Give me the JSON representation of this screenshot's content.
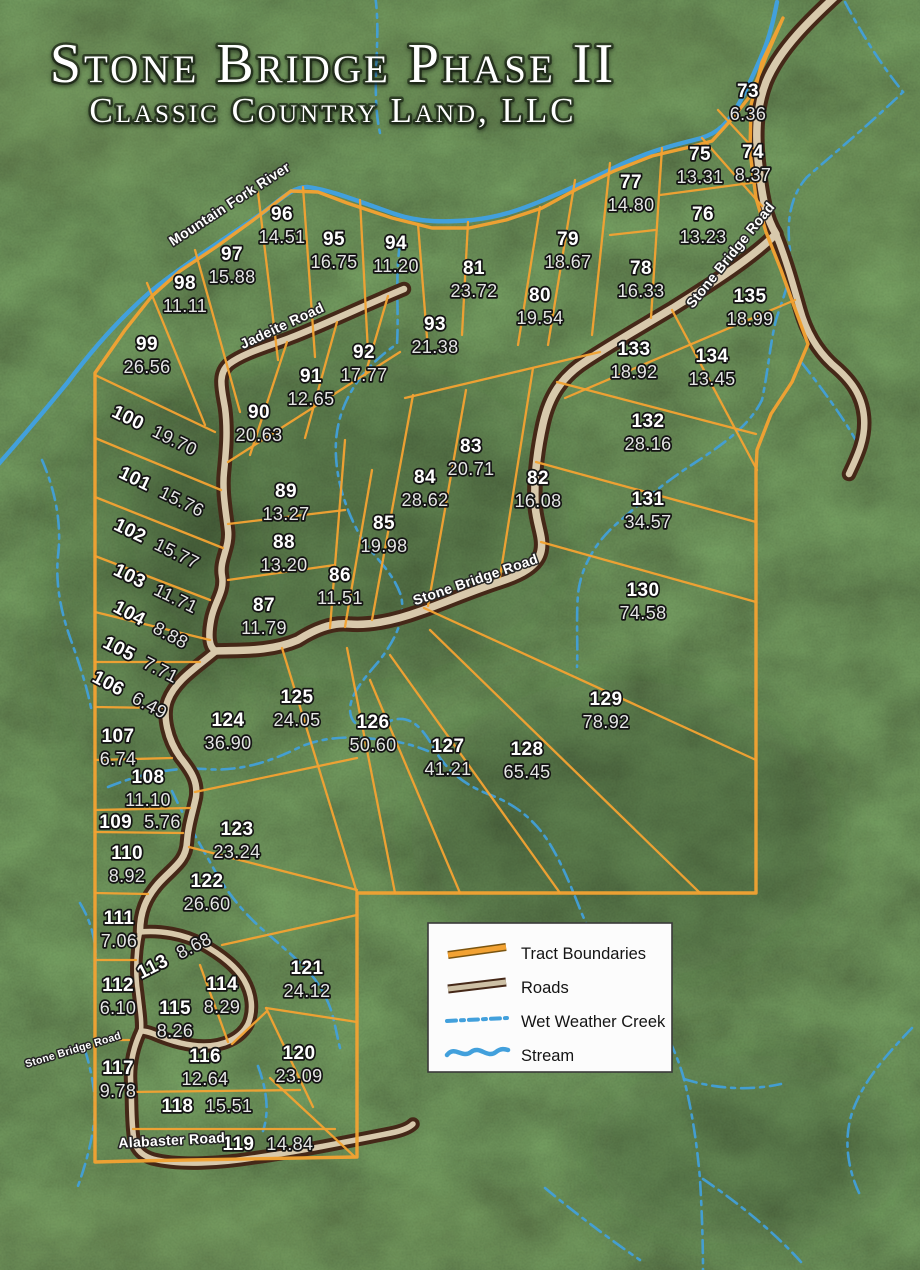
{
  "title": {
    "main": "Stone Bridge Phase II",
    "sub": "Classic Country Land, LLC"
  },
  "colors": {
    "boundary": "#F2A233",
    "road": "#D8C9AC",
    "road_casing": "#452818",
    "water": "#42A0DC",
    "label": "#FFFFFF"
  },
  "legend": {
    "items": [
      {
        "label": "Tract Boundaries",
        "swatch": "boundary"
      },
      {
        "label": "Roads",
        "swatch": "road"
      },
      {
        "label": "Wet Weather Creek",
        "swatch": "creek"
      },
      {
        "label": "Stream",
        "swatch": "stream"
      }
    ]
  },
  "road_labels": [
    {
      "text": "Mountain Fork River",
      "x": 232,
      "y": 208,
      "rot": -33,
      "size": 14
    },
    {
      "text": "Jadeite Road",
      "x": 284,
      "y": 330,
      "rot": -25,
      "size": 14
    },
    {
      "text": "Stone Bridge Road",
      "x": 734,
      "y": 258,
      "rot": -51,
      "size": 14
    },
    {
      "text": "Stone Bridge Road",
      "x": 477,
      "y": 584,
      "rot": -19,
      "size": 14
    },
    {
      "text": "Stone Bridge Road",
      "x": 74,
      "y": 1053,
      "rot": -17,
      "size": 10.5
    },
    {
      "text": "Alabaster Road",
      "x": 172,
      "y": 1145,
      "rot": -3,
      "size": 14
    }
  ],
  "tracts": [
    {
      "n": "73",
      "a": "6.36",
      "x": 748,
      "y": 97
    },
    {
      "n": "74",
      "a": "8.37",
      "x": 753,
      "y": 158
    },
    {
      "n": "75",
      "a": "13.31",
      "x": 700,
      "y": 160
    },
    {
      "n": "76",
      "a": "13.23",
      "x": 703,
      "y": 220
    },
    {
      "n": "77",
      "a": "14.80",
      "x": 631,
      "y": 188
    },
    {
      "n": "78",
      "a": "16.33",
      "x": 641,
      "y": 274
    },
    {
      "n": "79",
      "a": "18.67",
      "x": 568,
      "y": 245
    },
    {
      "n": "80",
      "a": "19.54",
      "x": 540,
      "y": 301
    },
    {
      "n": "81",
      "a": "23.72",
      "x": 474,
      "y": 274
    },
    {
      "n": "82",
      "a": "16.08",
      "x": 538,
      "y": 484
    },
    {
      "n": "83",
      "a": "20.71",
      "x": 471,
      "y": 452
    },
    {
      "n": "84",
      "a": "28.62",
      "x": 425,
      "y": 483
    },
    {
      "n": "85",
      "a": "19.98",
      "x": 384,
      "y": 529
    },
    {
      "n": "86",
      "a": "11.51",
      "x": 340,
      "y": 581
    },
    {
      "n": "87",
      "a": "11.79",
      "x": 264,
      "y": 611
    },
    {
      "n": "88",
      "a": "13.20",
      "x": 284,
      "y": 548
    },
    {
      "n": "89",
      "a": "13.27",
      "x": 286,
      "y": 497
    },
    {
      "n": "90",
      "a": "20.63",
      "x": 259,
      "y": 418
    },
    {
      "n": "91",
      "a": "12.65",
      "x": 311,
      "y": 382
    },
    {
      "n": "92",
      "a": "17.77",
      "x": 364,
      "y": 358
    },
    {
      "n": "93",
      "a": "21.38",
      "x": 435,
      "y": 330
    },
    {
      "n": "94",
      "a": "11.20",
      "x": 396,
      "y": 249
    },
    {
      "n": "95",
      "a": "16.75",
      "x": 334,
      "y": 245
    },
    {
      "n": "96",
      "a": "14.51",
      "x": 282,
      "y": 220
    },
    {
      "n": "97",
      "a": "15.88",
      "x": 232,
      "y": 260
    },
    {
      "n": "98",
      "a": "11.11",
      "x": 185,
      "y": 289
    },
    {
      "n": "99",
      "a": "26.56",
      "x": 147,
      "y": 350
    },
    {
      "n": "100",
      "a": "19.70",
      "x": 152,
      "y": 436,
      "rot": 26,
      "inline": true
    },
    {
      "n": "101",
      "a": "15.76",
      "x": 159,
      "y": 497,
      "rot": 26,
      "inline": true
    },
    {
      "n": "102",
      "a": "15.77",
      "x": 154,
      "y": 549,
      "rot": 26,
      "inline": true
    },
    {
      "n": "103",
      "a": "11.71",
      "x": 153,
      "y": 594,
      "rot": 26,
      "inline": true
    },
    {
      "n": "104",
      "a": "8.88",
      "x": 148,
      "y": 630,
      "rot": 28,
      "inline": true
    },
    {
      "n": "105",
      "a": "7.71",
      "x": 138,
      "y": 665,
      "rot": 27,
      "inline": true
    },
    {
      "n": "106",
      "a": "6.49",
      "x": 127,
      "y": 700,
      "rot": 28,
      "inline": true
    },
    {
      "n": "107",
      "a": "6.74",
      "x": 118,
      "y": 742
    },
    {
      "n": "108",
      "a": "11.10",
      "x": 148,
      "y": 783
    },
    {
      "n": "109",
      "a": "5.76",
      "x": 140,
      "y": 828,
      "inline": true
    },
    {
      "n": "110",
      "a": "8.92",
      "x": 127,
      "y": 859
    },
    {
      "n": "111",
      "a": "7.06",
      "x": 119,
      "y": 924
    },
    {
      "n": "112",
      "a": "6.10",
      "x": 118,
      "y": 991
    },
    {
      "n": "113",
      "a": "8.68",
      "x": 177,
      "y": 961,
      "rot": -27,
      "inline": true
    },
    {
      "n": "114",
      "a": "8.29",
      "x": 222,
      "y": 990
    },
    {
      "n": "115",
      "a": "8.26",
      "x": 175,
      "y": 1014
    },
    {
      "n": "116",
      "a": "12.64",
      "x": 205,
      "y": 1062
    },
    {
      "n": "117",
      "a": "9.78",
      "x": 118,
      "y": 1074
    },
    {
      "n": "118",
      "a": "15.51",
      "x": 207,
      "y": 1112,
      "inline": true
    },
    {
      "n": "119",
      "a": "14.84",
      "x": 268,
      "y": 1150,
      "inline": true
    },
    {
      "n": "120",
      "a": "23.09",
      "x": 299,
      "y": 1059
    },
    {
      "n": "121",
      "a": "24.12",
      "x": 307,
      "y": 974
    },
    {
      "n": "122",
      "a": "26.60",
      "x": 207,
      "y": 887
    },
    {
      "n": "123",
      "a": "23.24",
      "x": 237,
      "y": 835
    },
    {
      "n": "124",
      "a": "36.90",
      "x": 228,
      "y": 726
    },
    {
      "n": "125",
      "a": "24.05",
      "x": 297,
      "y": 703
    },
    {
      "n": "126",
      "a": "50.60",
      "x": 373,
      "y": 728
    },
    {
      "n": "127",
      "a": "41.21",
      "x": 448,
      "y": 752
    },
    {
      "n": "128",
      "a": "65.45",
      "x": 527,
      "y": 755
    },
    {
      "n": "129",
      "a": "78.92",
      "x": 606,
      "y": 705
    },
    {
      "n": "130",
      "a": "74.58",
      "x": 643,
      "y": 596
    },
    {
      "n": "131",
      "a": "34.57",
      "x": 648,
      "y": 505
    },
    {
      "n": "132",
      "a": "28.16",
      "x": 648,
      "y": 427
    },
    {
      "n": "133",
      "a": "18.92",
      "x": 634,
      "y": 355
    },
    {
      "n": "134",
      "a": "13.45",
      "x": 712,
      "y": 362
    },
    {
      "n": "135",
      "a": "18.99",
      "x": 750,
      "y": 302
    }
  ],
  "map": {
    "river": "M -5,468 C 20,440 45,410 68,382 C 92,350 118,320 150,292 C 182,266 220,242 258,216 C 276,204 292,186 308,187 C 330,190 352,199 395,214 C 420,223 448,222 472,220 C 500,217 520,210 546,199 C 572,188 598,176 622,164 C 648,152 670,146 694,140 C 712,136 724,128 734,112 C 744,96 754,74 764,50 C 770,35 774,18 777,2",
    "creeks": [
      "M 375,-5 C 382,40 370,88 380,133",
      "M 845,2 C 866,42 884,68 903,92 C 872,122 838,150 807,177 C 791,195 786,220 790,250 C 794,274 783,297 776,320 C 770,344 768,372 762,400 C 749,427 719,447 693,464 C 665,482 639,504 613,527 C 595,544 581,567 578,594 C 576,620 578,646 577,667",
      "M 802,363 C 823,390 843,417 858,444",
      "M 400,243 C 395,278 399,312 397,344 C 362,368 339,400 336,441 C 334,477 346,511 362,539 C 378,561 394,574 401,596 C 406,617 396,639 379,661 C 362,681 346,699 351,716 C 356,731 373,729 390,721 C 408,714 421,725 433,747 C 446,770 463,784 488,794 C 513,803 533,818 548,841 C 562,863 572,889 582,914 C 595,944 616,971 640,997 C 660,1019 675,1047 684,1079 C 692,1111 697,1144 700,1179 C 702,1214 703,1244 703,1272",
      "M 684,1079 C 716,1089 749,1091 781,1084",
      "M 703,1179 C 740,1204 776,1234 801,1262",
      "M 912,1028 C 885,1056 862,1083 852,1113 C 843,1141 848,1171 861,1197",
      "M 42,460 C 55,490 62,523 58,556 C 55,586 62,616 72,643 C 80,666 88,690 92,713",
      "M 108,787 C 140,774 172,767 205,769 C 240,772 272,761 300,747 C 330,734 362,737 392,741 C 406,743 418,747 428,751",
      "M 172,791 C 185,819 200,844 215,871 C 228,894 245,914 262,929 C 278,943 295,957 308,971 C 319,983 326,996 331,1010 C 335,1023 337,1036 340,1048",
      "M 258,1066 C 266,1088 270,1110 263,1131",
      "M 85,1050 C 92,1073 97,1098 94,1123 C 91,1146 85,1166 78,1186",
      "M 545,1188 C 575,1213 608,1238 640,1260",
      "M 80,903 C 92,923 98,946 95,970"
    ],
    "roads": [
      {
        "d": "M 838,-6 C 812,18 780,48 766,82 C 756,108 755,136 759,168 C 762,196 766,218 776,234 C 752,258 716,281 673,308 C 641,327 612,344 586,361 C 561,377 549,397 543,424 C 537,451 534,477 535,504 C 536,524 544,537 541,551 C 538,566 521,575 499,582 C 471,591 449,601 421,611 C 399,619 373,626 349,624 C 331,622 312,631 298,640 C 270,652 240,650 216,651",
        "w": 11
      },
      {
        "d": "M 776,234 C 786,259 793,284 800,309 C 806,331 816,349 832,364 C 850,379 862,394 864,417 C 866,439 857,457 849,474",
        "w": 10
      },
      {
        "d": "M 404,289 C 370,303 330,322 295,336 C 270,346 245,352 229,364 C 217,374 222,390 225,408 C 228,430 226,452 224,472 C 222,492 226,512 228,530 C 230,548 219,560 222,576 C 225,592 214,602 211,620 C 208,636 209,648 216,651 C 196,668 176,680 168,700 C 162,716 168,740 180,757 C 192,772 198,782 196,797 C 193,812 188,825 187,842 C 186,862 172,868 158,884 C 146,898 140,912 140,932",
        "w": 10
      },
      {
        "d": "M 140,932 C 160,930 184,934 202,944 C 220,954 236,966 244,980 C 252,994 254,1010 248,1024 C 241,1038 224,1046 204,1046 C 186,1046 168,1040 154,1034 C 149,1032 145,1031 141,1031",
        "w": 9
      },
      {
        "d": "M 140,932 C 136,952 135,972 138,992 C 140,1010 142,1022 141,1031",
        "w": 8
      },
      {
        "d": "M 141,1031 C 133,1048 129,1066 131,1086 C 132,1104 131,1122 134,1140 C 136,1150 143,1156 153,1159 C 181,1166 221,1163 253,1158 C 296,1152 346,1142 391,1133 C 401,1131 409,1128 413,1124",
        "w": 9
      }
    ],
    "outer": "M 95,373 L 125,330 L 152,296 L 180,271 L 216,247 L 252,221 L 291,191 L 318,192 L 347,203 L 392,218 L 432,228 L 469,228 L 506,220 L 542,208 L 577,189 L 614,171 L 652,156 L 690,147 L 712,141 L 731,120 L 751,95 L 766,57 L 783,18 L 762,62 L 751,105 L 750,152 L 756,198 L 766,232 L 781,270 L 794,306 L 808,344 L 792,382 L 771,414 L 757,450 L 756,470 L 756,893 L 357,893 L 357,1157 L 133,1161 L 95,1162 Z",
    "segments": [
      [
        718,
        110,
        753,
        148
      ],
      [
        702,
        138,
        762,
        206
      ],
      [
        660,
        195,
        758,
        182
      ],
      [
        610,
        235,
        655,
        230
      ],
      [
        662,
        148,
        651,
        318
      ],
      [
        610,
        163,
        592,
        335
      ],
      [
        575,
        180,
        548,
        345
      ],
      [
        540,
        207,
        518,
        345
      ],
      [
        468,
        222,
        462,
        335
      ],
      [
        418,
        224,
        428,
        350
      ],
      [
        360,
        200,
        368,
        352
      ],
      [
        303,
        187,
        315,
        357
      ],
      [
        258,
        192,
        278,
        360
      ],
      [
        195,
        250,
        240,
        412
      ],
      [
        147,
        283,
        205,
        425
      ],
      [
        95,
        375,
        215,
        432
      ],
      [
        95,
        438,
        221,
        490
      ],
      [
        95,
        497,
        223,
        548
      ],
      [
        95,
        556,
        210,
        600
      ],
      [
        95,
        612,
        210,
        640
      ],
      [
        95,
        662,
        200,
        662
      ],
      [
        95,
        707,
        162,
        708
      ],
      [
        95,
        760,
        172,
        758
      ],
      [
        95,
        810,
        190,
        808
      ],
      [
        95,
        832,
        183,
        833
      ],
      [
        95,
        893,
        148,
        894
      ],
      [
        95,
        960,
        136,
        960
      ],
      [
        95,
        1040,
        129,
        1040
      ],
      [
        228,
        462,
        400,
        352
      ],
      [
        287,
        342,
        250,
        455
      ],
      [
        337,
        322,
        305,
        438
      ],
      [
        388,
        296,
        365,
        375
      ],
      [
        228,
        524,
        345,
        510
      ],
      [
        228,
        580,
        335,
        565
      ],
      [
        345,
        440,
        330,
        628
      ],
      [
        372,
        470,
        345,
        627
      ],
      [
        413,
        395,
        372,
        620
      ],
      [
        405,
        398,
        600,
        352
      ],
      [
        466,
        390,
        428,
        606
      ],
      [
        533,
        368,
        500,
        577
      ],
      [
        672,
        310,
        757,
        470
      ],
      [
        795,
        300,
        565,
        398
      ],
      [
        557,
        382,
        756,
        434
      ],
      [
        536,
        462,
        756,
        522
      ],
      [
        541,
        542,
        756,
        602
      ],
      [
        424,
        608,
        756,
        760
      ],
      [
        430,
        630,
        700,
        893
      ],
      [
        390,
        655,
        560,
        893
      ],
      [
        370,
        680,
        460,
        893
      ],
      [
        347,
        648,
        395,
        893
      ],
      [
        282,
        648,
        357,
        893
      ],
      [
        195,
        792,
        357,
        758
      ],
      [
        189,
        847,
        357,
        890
      ],
      [
        222,
        945,
        357,
        915
      ],
      [
        266,
        1008,
        357,
        1022
      ],
      [
        266,
        1008,
        313,
        1107
      ],
      [
        232,
        1044,
        266,
        1012
      ],
      [
        130,
        1092,
        300,
        1090
      ],
      [
        133,
        1129,
        335,
        1129
      ],
      [
        270,
        1078,
        355,
        1157
      ],
      [
        200,
        965,
        228,
        1042
      ]
    ]
  }
}
